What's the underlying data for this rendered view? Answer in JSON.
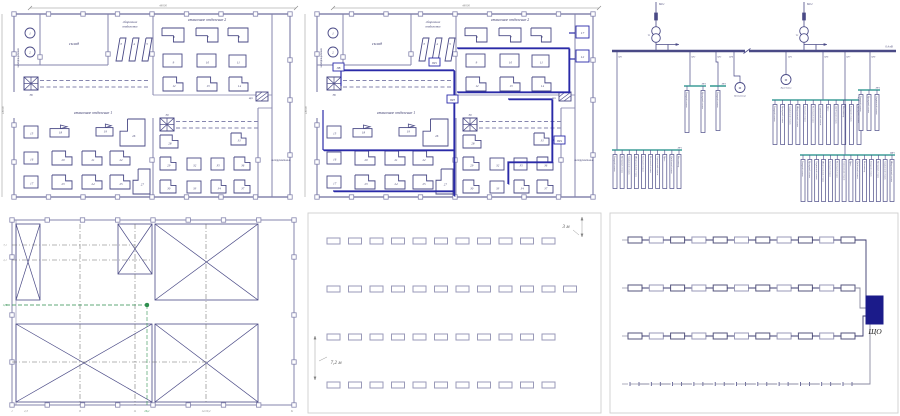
{
  "colors": {
    "line": "#8585ae",
    "dark": "#4a4a86",
    "wire": "#2a2aa8",
    "teal": "#3f9e98",
    "green": "#2f8f4f",
    "panel": "#1b1b8a",
    "text": "#3c3c6e",
    "dim": "#8a8a8a",
    "frame": "#cfcfcf",
    "fixture": "#9a9ab8",
    "fixture2": "#55557e"
  },
  "plan": {
    "dim_width": "48000",
    "dim_height": "18000",
    "rooms": {
      "warehouse": "склад",
      "assembly_l1": "сборочное",
      "assembly_l2": "отделение",
      "machine2": "станочное отделение 2",
      "machine1": "станочное отделение 1",
      "tool": "инструментальн.",
      "substation": "электрощитовая"
    },
    "machine_numbers": [
      "1",
      "2",
      "3",
      "4",
      "5",
      "6",
      "7",
      "8",
      "9",
      "10",
      "11",
      "12",
      "13",
      "14",
      "15",
      "18",
      "19",
      "26",
      "16",
      "20",
      "21",
      "22",
      "17",
      "23",
      "24",
      "25",
      "27",
      "28",
      "31",
      "29",
      "32",
      "35",
      "36",
      "30",
      "33",
      "34",
      "37"
    ],
    "crane_labels": [
      "38",
      "39"
    ],
    "corner_box_label": "ЩО"
  },
  "plan_wired": {
    "pr_boxes": [
      "ПВ",
      "ПР1",
      "ПР3",
      "ПР4"
    ],
    "right_boxes": [
      "17",
      "12"
    ]
  },
  "sld": {
    "incomers": [
      {
        "line": "ВЛ-1",
        "transformer": "Т1"
      },
      {
        "line": "ВЛ-2",
        "transformer": "Т2"
      }
    ],
    "bus_label": "0,4 кВ",
    "feeder_labels": [
      "QF1",
      "QF2",
      "QF3",
      "QF4",
      "QF5",
      "QF6",
      "QF7",
      "QF8"
    ],
    "group_labels": [
      "ПР1",
      "ПР2",
      "ПР3",
      "ПР4",
      "ПР5",
      "ЩР1"
    ],
    "motor_labels": [
      "Вентилятор",
      "Кран-балка"
    ],
    "load_names": [
      "Токарный станок",
      "Фрезерный станок",
      "Сверлильный станок",
      "Шлифовальный станок",
      "Заточной станок",
      "Расточной станок",
      "Строгальный станок",
      "Пресс",
      "Долбёжный станок",
      "Вентилятор"
    ],
    "load_counts": {
      "pr1": 10,
      "pr2": 2,
      "pr3": 1,
      "pr4": 12,
      "pr5": 3,
      "sch": 14
    }
  },
  "axes_plan": {
    "bottom_labels": [
      "1",
      "2,3",
      "8",
      "11",
      "26,1",
      "12/10,2",
      "К"
    ],
    "left_labels": [
      {
        "y": 33,
        "t": "7,1"
      },
      {
        "y": 48,
        "t": "2,1"
      },
      {
        "y": 93,
        "t": "1,05",
        "g": true
      }
    ]
  },
  "lighting_layout": {
    "dim_col": "3 м",
    "dim_row": "7,2 м",
    "row_counts": [
      11,
      12,
      11,
      11
    ]
  },
  "lighting_network": {
    "panel_label": "ЩО",
    "row_counts": [
      11,
      11,
      11,
      11
    ]
  }
}
